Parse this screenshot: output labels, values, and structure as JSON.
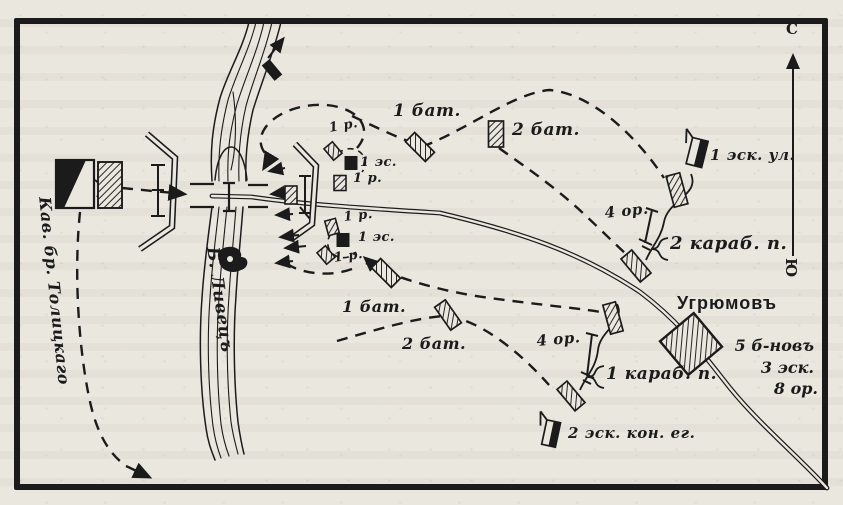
{
  "colors": {
    "ink": "#1b1b1b",
    "paper": "#eae7df"
  },
  "compass": {
    "north": "С",
    "south": "Ю"
  },
  "river": {
    "label": "Б. Ливецъ"
  },
  "routes": {
    "cavalry_brigade": "Кав. бр. Толицкаго"
  },
  "bridgehead": {
    "rota": "1 р.",
    "squadron": "1 эс."
  },
  "north_column": {
    "bat1": "1 бат.",
    "bat2": "2 бат.",
    "guns": "4 ор.",
    "regiment": "2 караб. п.",
    "uhlan_squadron": "1 эск. ул."
  },
  "south_column": {
    "bat1": "1 бат.",
    "bat2": "2 бат.",
    "guns": "4 ор.",
    "regiment": "1 караб. п.",
    "jager_squadrons": "2 эск. кон. ег."
  },
  "town": {
    "name": "Угрюмовъ",
    "garrison": [
      "5 б-новъ",
      "3 эск.",
      "8 ор."
    ]
  }
}
